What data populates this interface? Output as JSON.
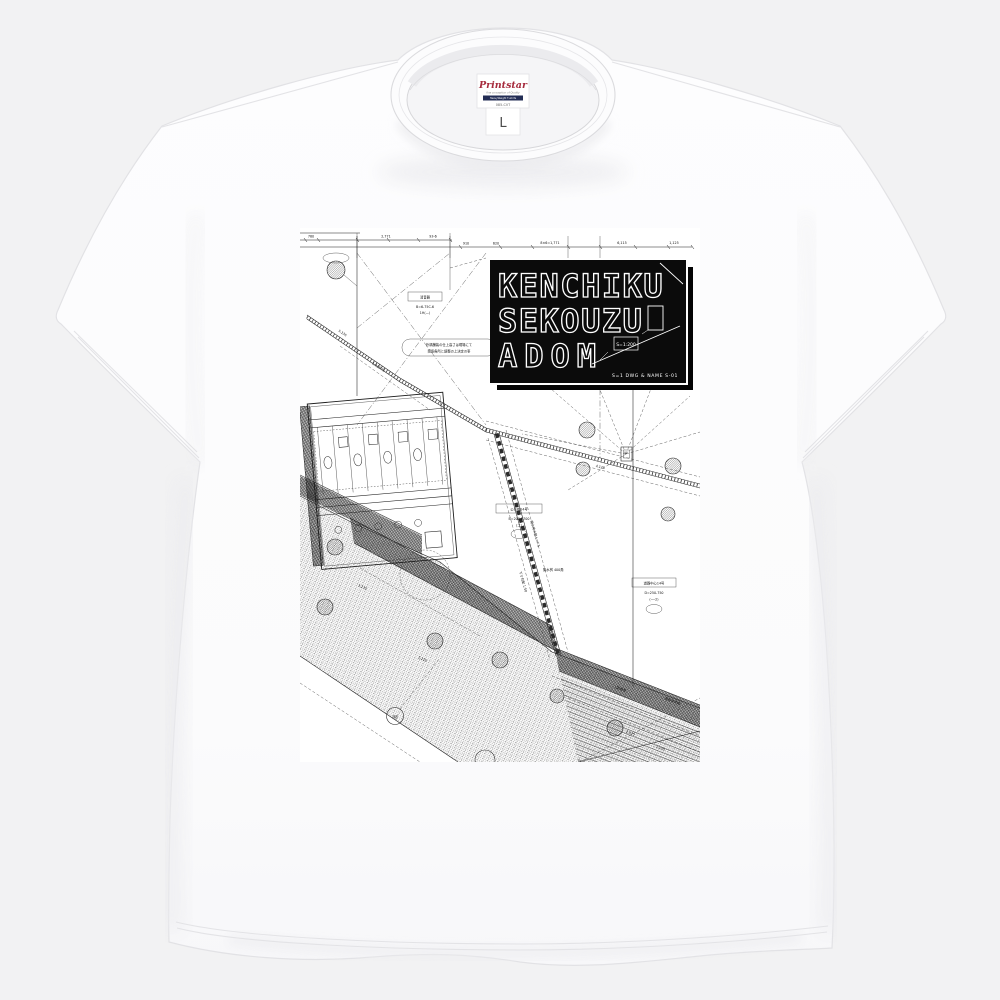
{
  "page": {
    "background": "#f2f2f3"
  },
  "shirt": {
    "fabric_color": "#fcfcfd",
    "brand_label": {
      "brand": "Printstar",
      "tagline": "fine conception of Quality",
      "bar_text": "HeavyWeight T-shirts",
      "model": "085-CVT"
    },
    "size_label": {
      "size": "L"
    }
  },
  "print": {
    "logo": {
      "bg": "#0b0b0b",
      "stroke": "#ffffff",
      "line1": "KENCHIKU",
      "line2": "SEKOUZU",
      "line3": "ADOM",
      "minibox": "S=1:200",
      "caption": "S=1 DWG & NAME S-01"
    },
    "drawing": {
      "ink": "#1c1c1c",
      "top_dims": [
        "780",
        "2,771",
        "93-6",
        "910",
        "620",
        "8×6=1,771",
        "6,115",
        "1,125"
      ],
      "diag_dims": [
        "5,135",
        "1,319.75",
        "4,125",
        "3,135",
        "1,210",
        "2,025",
        "1,125"
      ],
      "marker": "A8",
      "muffler_box": {
        "title": "消音器",
        "l1": "B=6-75C-6",
        "l2": "1H(—)"
      },
      "note": {
        "l1": "外構舗装の仕上高さは現場にて",
        "l2": "関係各所と調整の上決定の事"
      },
      "box1": {
        "title": "公共桝14号",
        "l1": "B=200-2700",
        "l2": "(二)"
      },
      "box2": {
        "title": "道路中心14号",
        "l1": "D=250-750",
        "l2": "(一-2)"
      },
      "pipe_labels": [
        "雨水排水管 L=7.5",
        "下り勾配 1:50",
        "集水桝 400角",
        "L型側溝",
        "道路境界線"
      ]
    }
  }
}
